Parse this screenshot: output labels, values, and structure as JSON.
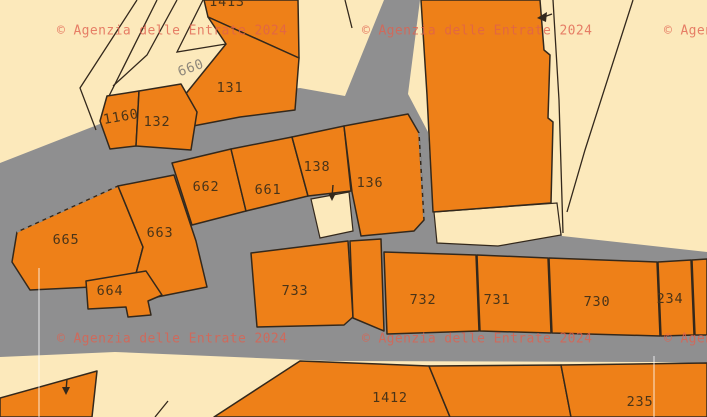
{
  "map": {
    "watermark": {
      "text": "© Agenzia delle Entrate 2024",
      "color": "#E0604E",
      "opacity": 0.78,
      "positions": [
        {
          "x": 57,
          "y": 31
        },
        {
          "x": 362,
          "y": 31
        },
        {
          "x": 664,
          "y": 31
        },
        {
          "x": 57,
          "y": 339
        },
        {
          "x": 362,
          "y": 339
        },
        {
          "x": 664,
          "y": 339
        }
      ]
    },
    "colors": {
      "background": "#FCE9BB",
      "road": "#8F8F90",
      "parcel": "#EE8018",
      "boundary": "#33281C",
      "parcel_label": "#4A3418",
      "road_label": "#8F887B",
      "grid_line": "#FFFFFF"
    },
    "road_polygon": "0,163 110,120 150,112 185,103 300,88 345,96 384,0 420,0 408,94 428,132 433,213 557,203 562,236 707,252 707,363 654,362 330,361 115,352 0,357",
    "cream_patches": [
      {
        "name": "wedge-below-large-parcel",
        "points": "434,212 557,203 561,235 498,246 437,243"
      },
      {
        "name": "notch-below-661",
        "points": "311,199 349,192 353,231 320,238"
      }
    ],
    "boundary_lines": [
      {
        "name": "upper-left-outer",
        "points": "137,0 80,88 96,130"
      },
      {
        "name": "upper-left-inner",
        "points": "157,0 108,98"
      },
      {
        "name": "path-strip-left",
        "points": "177,0 147,55 113,86"
      },
      {
        "name": "road-660-border",
        "points": "203,0 177,52 226,44"
      },
      {
        "name": "top-center-stub",
        "points": "345,0 352,28"
      },
      {
        "name": "right-area-line-a",
        "points": "553,0 559,100 563,233"
      },
      {
        "name": "right-area-line-b",
        "points": "633,0 585,150 567,212"
      },
      {
        "name": "bottom-cream-stub",
        "points": "155,417 168,401"
      }
    ],
    "parcels": [
      {
        "id": "1413",
        "label": "1413",
        "points": "204,0 298,0 299,58 208,17",
        "lx": 227,
        "ly": 2,
        "rot": 0
      },
      {
        "id": "131",
        "label": "131",
        "points": "208,17 299,58 295,110 240,117 193,126 184,96 226,44",
        "lx": 230,
        "ly": 88,
        "rot": 0
      },
      {
        "id": "1160",
        "label": "1160",
        "points": "107,96 139,91 136,146 110,149 100,121",
        "lx": 121,
        "ly": 117,
        "rot": -10
      },
      {
        "id": "132",
        "label": "132",
        "points": "139,91 181,84 197,112 191,150 136,146",
        "lx": 157,
        "ly": 122,
        "rot": 0
      },
      {
        "id": "662",
        "label": "662",
        "points": "172,163 231,149 246,211 192,225",
        "lx": 206,
        "ly": 187,
        "rot": 0
      },
      {
        "id": "661",
        "label": "661",
        "points": "231,149 292,137 308,196 246,211",
        "lx": 268,
        "ly": 190,
        "rot": 0
      },
      {
        "id": "138",
        "label": "138",
        "points": "292,137 344,126 351,191 308,196",
        "lx": 317,
        "ly": 167,
        "rot": 0
      },
      {
        "id": "136",
        "label": "136",
        "points": "344,126 408,114 419,133 424,220 414,231 361,236 352,192",
        "lx": 370,
        "ly": 183,
        "rot": 0
      },
      {
        "id": "large-unlabeled",
        "label": "",
        "points": "421,0 540,0 544,50 550,55 548,118 553,122 551,203 433,212 427,95",
        "lx": 0,
        "ly": 0,
        "rot": 0
      },
      {
        "id": "665",
        "label": "665",
        "points": "17,232 118,186 143,247 133,285 30,290 12,262",
        "lx": 66,
        "ly": 240,
        "rot": 0
      },
      {
        "id": "663",
        "label": "663",
        "points": "118,186 174,175 196,241 207,287 152,298 133,285 143,247",
        "lx": 160,
        "ly": 233,
        "rot": 0
      },
      {
        "id": "664",
        "label": "664",
        "points": "86,281 146,271 162,295 148,301 151,315 128,317 126,307 88,309",
        "lx": 110,
        "ly": 291,
        "rot": 0
      },
      {
        "id": "733",
        "label": "733",
        "points": "251,253 348,241 353,317 344,325 257,327",
        "lx": 295,
        "ly": 291,
        "rot": 0
      },
      {
        "id": "sliver-733-732",
        "label": "",
        "points": "350,241 381,239 384,331 353,318",
        "lx": 0,
        "ly": 0,
        "rot": 0
      },
      {
        "id": "732",
        "label": "732",
        "points": "384,252 476,255 479,331 387,334",
        "lx": 423,
        "ly": 300,
        "rot": 0
      },
      {
        "id": "731",
        "label": "731",
        "points": "477,255 548,258 551,333 480,331",
        "lx": 497,
        "ly": 300,
        "rot": 0
      },
      {
        "id": "730",
        "label": "730",
        "points": "549,258 657,262 660,336 552,333",
        "lx": 597,
        "ly": 302,
        "rot": 0
      },
      {
        "id": "234",
        "label": "234",
        "points": "658,262 691,260 694,335 661,336",
        "lx": 670,
        "ly": 299,
        "rot": 0
      },
      {
        "id": "sliver-right-edge",
        "label": "",
        "points": "692,260 707,259 707,335 695,335",
        "lx": 0,
        "ly": 0,
        "rot": 0
      },
      {
        "id": "bottom-left-unlabeled",
        "label": "",
        "points": "0,398 97,371 92,417 0,417",
        "lx": 0,
        "ly": 0,
        "rot": 0
      },
      {
        "id": "1412",
        "label": "1412",
        "points": "300,361 429,366 450,417 214,417",
        "lx": 390,
        "ly": 398,
        "rot": 0
      },
      {
        "id": "mid-bottom-unlabeled",
        "label": "",
        "points": "429,366 561,365 571,417 450,417",
        "lx": 0,
        "ly": 0,
        "rot": 0
      },
      {
        "id": "235",
        "label": "235",
        "points": "561,365 707,363 707,417 571,417",
        "lx": 640,
        "ly": 402,
        "rot": 0
      }
    ],
    "road_labels": [
      {
        "text": "660",
        "x": 191,
        "y": 68,
        "rot": -20
      }
    ],
    "dashed_edges": [
      {
        "x1": 17,
        "y1": 232,
        "x2": 118,
        "y2": 186
      },
      {
        "x1": 419,
        "y1": 133,
        "x2": 424,
        "y2": 220
      }
    ],
    "arrows": [
      {
        "name": "arrow-notch-661",
        "line": "333,185 332,197",
        "head": "328,193 336,193 332,201"
      },
      {
        "name": "arrow-large-parcel",
        "line": "552,14 541,18",
        "head": "547,12 546,22 537,18"
      },
      {
        "name": "arrow-bottom-left",
        "line": "67,379 66,391",
        "head": "62,387 70,387 66,395"
      }
    ],
    "grid_lines": [
      {
        "x1": 39,
        "y1": 268,
        "x2": 39,
        "y2": 417
      },
      {
        "x1": 654,
        "y1": 356,
        "x2": 654,
        "y2": 417
      }
    ]
  }
}
